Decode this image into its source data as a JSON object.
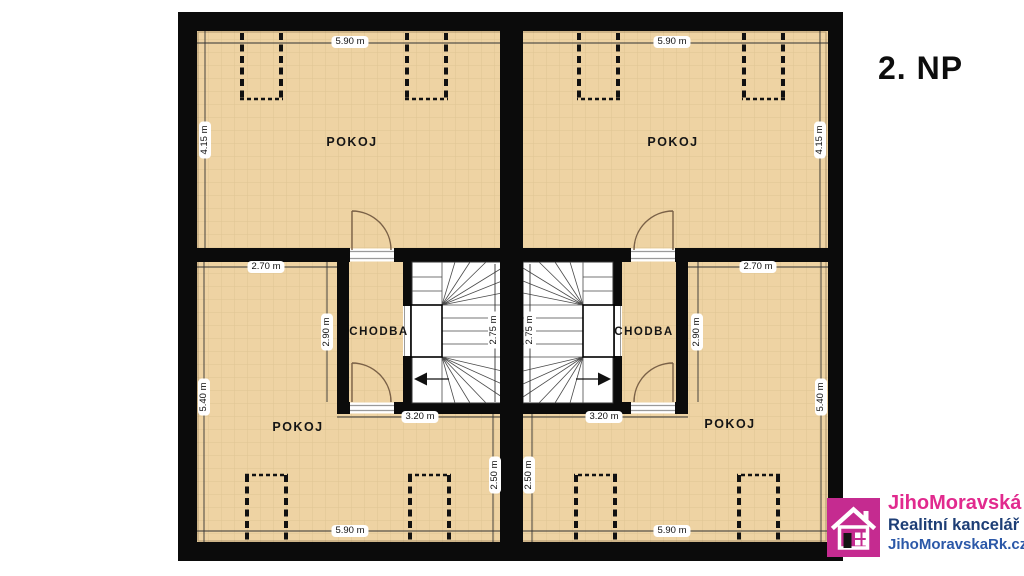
{
  "title": "2. NP",
  "units": {
    "left": {
      "room_top": "POKOJ",
      "room_bottom": "POKOJ",
      "hall": "CHODBA",
      "dims": {
        "top_width": "5.90 m",
        "top_height": "4.15 m",
        "inner_width": "2.70 m",
        "inner_height": "2.90 m",
        "outer_height": "5.40 m",
        "stair_depth": "2.75 m",
        "stair_width": "3.20 m",
        "lower_height": "2.50 m",
        "bottom_width": "5.90 m"
      }
    },
    "right": {
      "room_top": "POKOJ",
      "room_bottom": "POKOJ",
      "hall": "CHODBA",
      "dims": {
        "top_width": "5.90 m",
        "top_height": "4.15 m",
        "inner_width": "2.70 m",
        "inner_height": "2.90 m",
        "outer_height": "5.40 m",
        "stair_depth": "2.75 m",
        "stair_width": "3.20 m",
        "lower_height": "2.50 m",
        "bottom_width": "5.90 m"
      }
    }
  },
  "logo": {
    "brand": "JihoMoravská",
    "subtitle": "Realitní kancelář",
    "website": "JihoMoravskaRk.cz"
  },
  "colors": {
    "floor": "#eed3a3",
    "wall": "#0b0b0b",
    "logo_square_pink": "#c52b90",
    "brand_pink": "#e12a8e",
    "brand_navy": "#1d3e76",
    "brand_blue": "#2b58a8"
  }
}
